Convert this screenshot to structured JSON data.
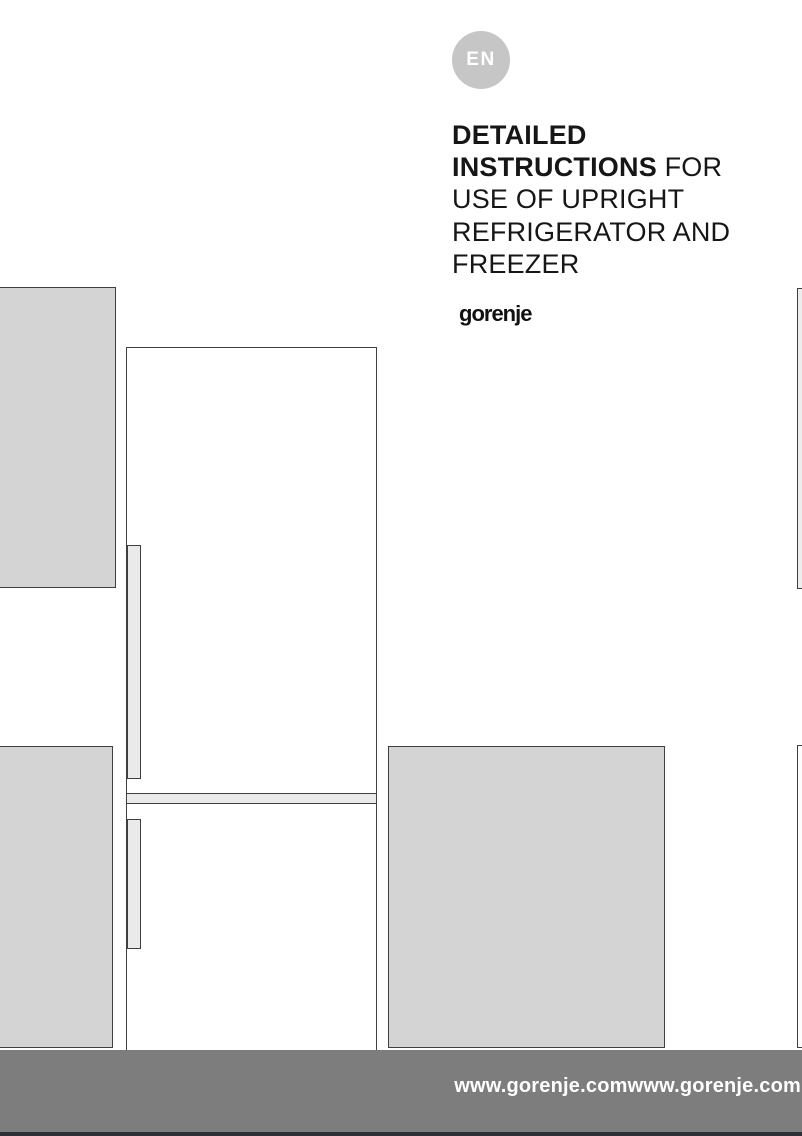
{
  "document": {
    "language_badge": "EN",
    "title": {
      "line1_bold": "DETAILED",
      "line2_bold": "INSTRUCTIONS",
      "line2_regular": " FOR",
      "line3": "USE OF UPRIGHT",
      "line4": "REFRIGERATOR AND",
      "line5": "FREEZER"
    },
    "brand_logo": "gorenje",
    "footer": {
      "url_text": "www.gorenje.comwww.gorenje.com"
    },
    "colors": {
      "badge_gray": "#c6c6c6",
      "panel_gray": "#d4d4d4",
      "handle_gray": "#eaeaea",
      "outline_dark": "#3f3f3f",
      "footer_gray": "#7d7d7d",
      "footer_strip_dark": "#2c2f33",
      "title_text": "#161616"
    }
  }
}
